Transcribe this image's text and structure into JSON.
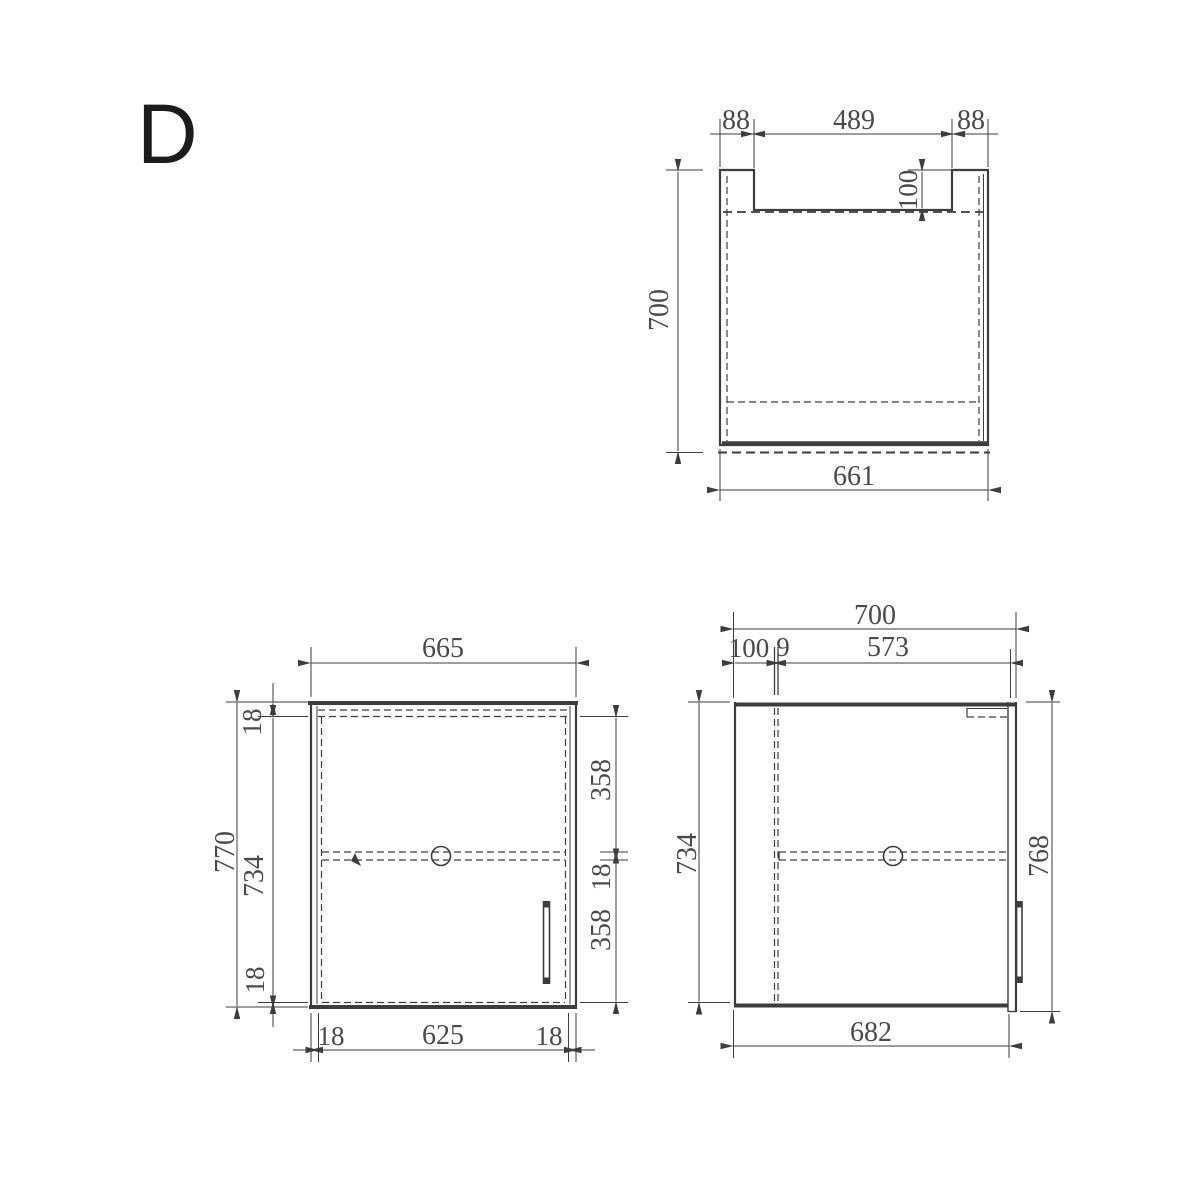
{
  "colors": {
    "background": "#ffffff",
    "line": "#3d3d3d",
    "text": "#4a4a4a",
    "sheet_label": "#1c1c1c"
  },
  "sheet": {
    "label": "D"
  },
  "top_view": {
    "dim_left_shoulder": "88",
    "dim_cutout_width": "489",
    "dim_right_shoulder": "88",
    "dim_cutout_depth": "100",
    "dim_depth": "700",
    "dim_width": "661"
  },
  "front_view": {
    "dim_width": "665",
    "dim_height": "770",
    "dim_top_panel": "18",
    "dim_inner_height": "734",
    "dim_bottom_panel": "18",
    "dim_upper_section": "358",
    "dim_shelf_thickness": "18",
    "dim_lower_section": "358",
    "dim_left_panel": "18",
    "dim_inner_width": "625",
    "dim_right_panel": "18"
  },
  "side_view": {
    "dim_depth": "700",
    "dim_back_gap": "100",
    "dim_partition": "9",
    "dim_front_section": "573",
    "dim_inner_height": "734",
    "dim_height": "768",
    "dim_bottom_depth": "682"
  }
}
